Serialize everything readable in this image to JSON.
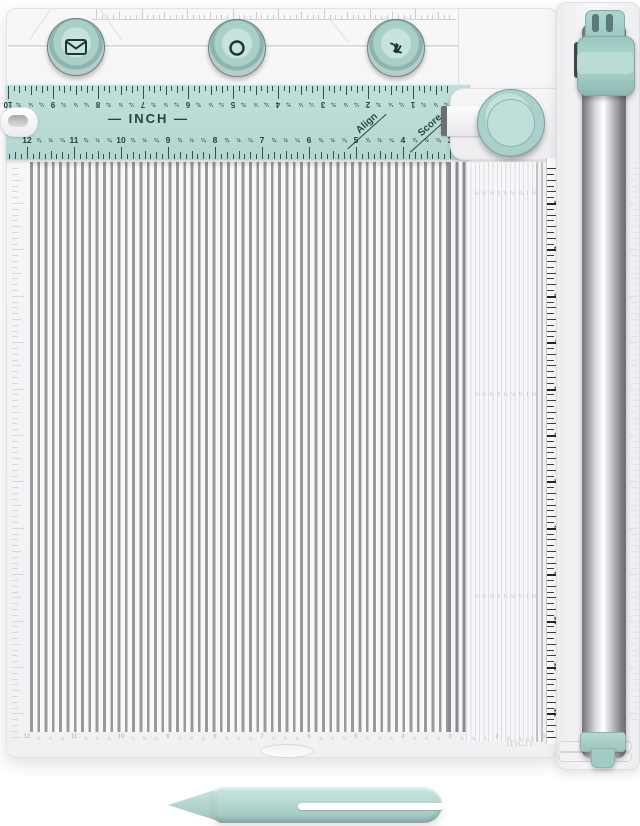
{
  "product": {
    "description": "Teal and white 12-inch paper trimmer and scoring board with three punch buttons, align/score dial, cutting rail and scoring stylus"
  },
  "colors": {
    "teal_ruler": "#b9d9d4",
    "teal_button": "#b7d9d3",
    "teal_dial": "#a9d0ca",
    "dark_marks": "#27413f",
    "groove_gray": "#9a9a9e",
    "rail_chrome": "#c7c7cb",
    "board_white": "#f4f4f6"
  },
  "buttons": [
    {
      "icon": "envelope-icon"
    },
    {
      "icon": "circle-icon"
    },
    {
      "icon": "bow-icon"
    }
  ],
  "top_ruler": {
    "inch_label": "— INCH —",
    "align_label": "Align",
    "score_label": "Score",
    "flipped_row": [
      "10",
      "¾",
      "½",
      "¼",
      "9",
      "¾",
      "½",
      "¼",
      "8",
      "¾",
      "½",
      "¼",
      "7",
      "¾",
      "½",
      "¼",
      "6",
      "¾",
      "½",
      "¼",
      "5",
      "¾",
      "½",
      "¼",
      "4",
      "¾",
      "½",
      "¼",
      "3",
      "¾",
      "½",
      "¼",
      "2",
      "¾",
      "½",
      "¼",
      "1",
      "¾",
      "½",
      "¼"
    ],
    "main_row": [
      "12",
      "¾",
      "½",
      "¼",
      "11",
      "¾",
      "½",
      "¼",
      "10",
      "¾",
      "½",
      "¼",
      "9",
      "¾",
      "½",
      "¼",
      "8",
      "¾",
      "½",
      "¼",
      "7",
      "¾",
      "½",
      "¼",
      "6",
      "¾",
      "½",
      "¼",
      "5",
      "¾",
      "½",
      "¼",
      "4",
      "¾",
      "½",
      "¼",
      "3"
    ]
  },
  "right_ruler": {
    "numbers": [
      "1",
      "2",
      "3",
      "4",
      "5",
      "6",
      "7",
      "8",
      "9",
      "10",
      "11",
      "12"
    ],
    "fractions": [
      "¼",
      "½",
      "¾"
    ]
  },
  "bottom_faint_row": [
    "12",
    "¾",
    "½",
    "¼",
    "11",
    "¾",
    "½",
    "¼",
    "10",
    "¾",
    "½",
    "¼",
    "9",
    "¾",
    "½",
    "¼",
    "8",
    "¾",
    "½",
    "¼",
    "7",
    "¾",
    "½",
    "¼",
    "6",
    "¾",
    "½",
    "¼",
    "5",
    "¾",
    "½",
    "¼",
    "4",
    "¾",
    "½",
    "¼",
    "3",
    "¾",
    "½",
    "¼",
    "2",
    "¾",
    "½",
    "¼",
    "1"
  ],
  "embossed": {
    "inch_label": "Inch",
    "mini_row": "¼ ½ ¾ 2 ¼ ½ ¾ 1 ¼"
  }
}
